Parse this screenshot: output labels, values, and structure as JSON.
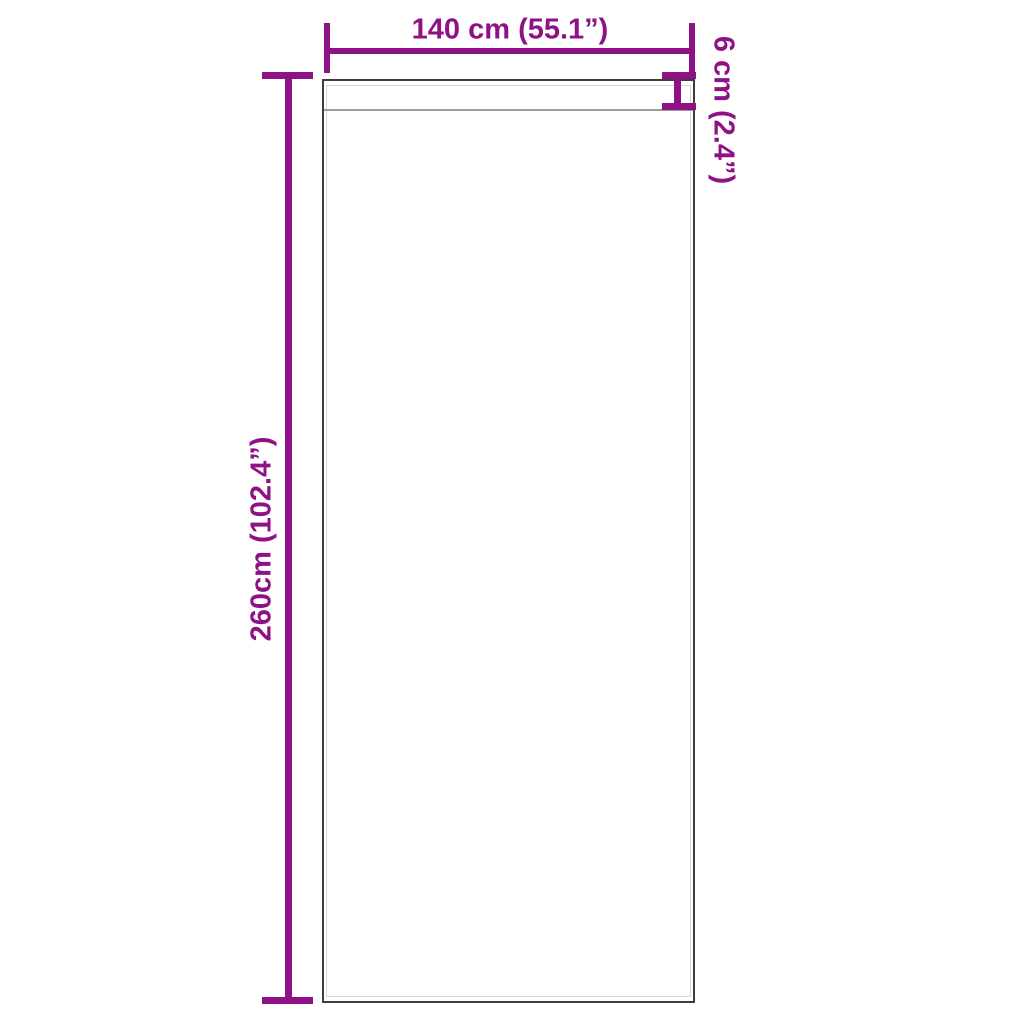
{
  "diagram": {
    "kind": "product-dimension-diagram",
    "subject": "curtain panel with rod pocket",
    "background_color": "#ffffff",
    "accent_color": "#8E1285",
    "outline_color": "#3e3e3e",
    "labels": {
      "width": "140 cm (55.1”)",
      "height": "260cm (102.4”)",
      "pocket": "6 cm (2.4”)"
    },
    "values": {
      "width_cm": 140,
      "width_in": 55.1,
      "height_cm": 260,
      "height_in": 102.4,
      "pocket_cm": 6,
      "pocket_in": 2.4
    }
  }
}
